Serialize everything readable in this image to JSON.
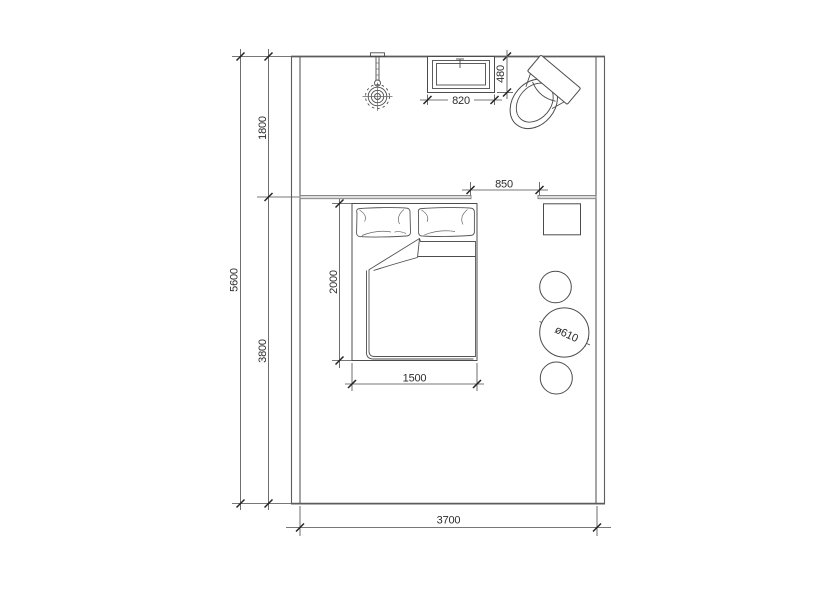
{
  "drawing": {
    "kind": "bedroom-floor-plan",
    "background": "#ffffff",
    "line_color": "#4c4c4c",
    "wall_color": "#5c5c5c",
    "partition_fill": "#dedede",
    "text_color": "#2d2d2d",
    "dims": {
      "total_depth": "5600",
      "upper_depth": "1800",
      "lower_depth": "3800",
      "room_width": "3700",
      "bed_length": "2000",
      "bed_width": "1500",
      "door_opening": "850",
      "window_width": "820",
      "window_depth": "480",
      "stool_diameter": "ø610"
    },
    "furniture": [
      "double-bed",
      "pillow-left",
      "pillow-right",
      "duvet",
      "nightstand",
      "stool-top",
      "stool-large",
      "stool-bottom",
      "pendant-light",
      "window-unit",
      "toilet"
    ]
  }
}
